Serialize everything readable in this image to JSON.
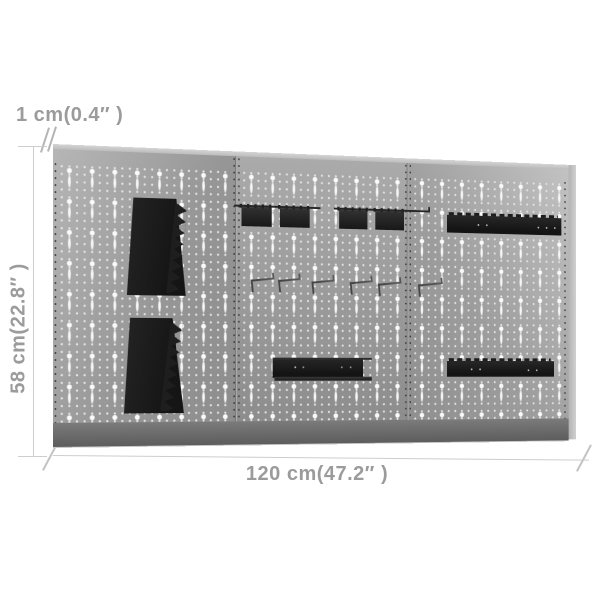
{
  "image": {
    "description": "Product dimension diagram of three wall-mounted grey pegboard panels fitted with black tool-holder accessories",
    "background_color": "#ffffff"
  },
  "dimensions": {
    "thickness_label": "1 cm(0.4″ )",
    "height_label": "58 cm(22.8″ )",
    "width_label": "120 cm(47.2″ )"
  },
  "pegboard": {
    "panel_count": 3,
    "face_color": "#9a9a9a",
    "hole_color": "#f7f7f7",
    "seam_color": "#787878",
    "bottom_rail_color": "#6b6b6b",
    "accessory_color": "#1d1d1d"
  },
  "accessories": [
    "serrated wrench holder upper-left",
    "serrated wrench holder lower-left",
    "hook bracket 1",
    "hook bracket 2",
    "hook bracket 3",
    "hook bracket 4",
    "wire hook 1",
    "wire hook 2",
    "wire hook 3",
    "wire hook 4",
    "wire hook 5",
    "wire hook 6",
    "serrated tool shelf top-right",
    "tool shelf center-bottom",
    "tool shelf bottom-right"
  ],
  "annotation": {
    "text_color": "#9b9b9b",
    "line_color": "#cdcdcd"
  }
}
